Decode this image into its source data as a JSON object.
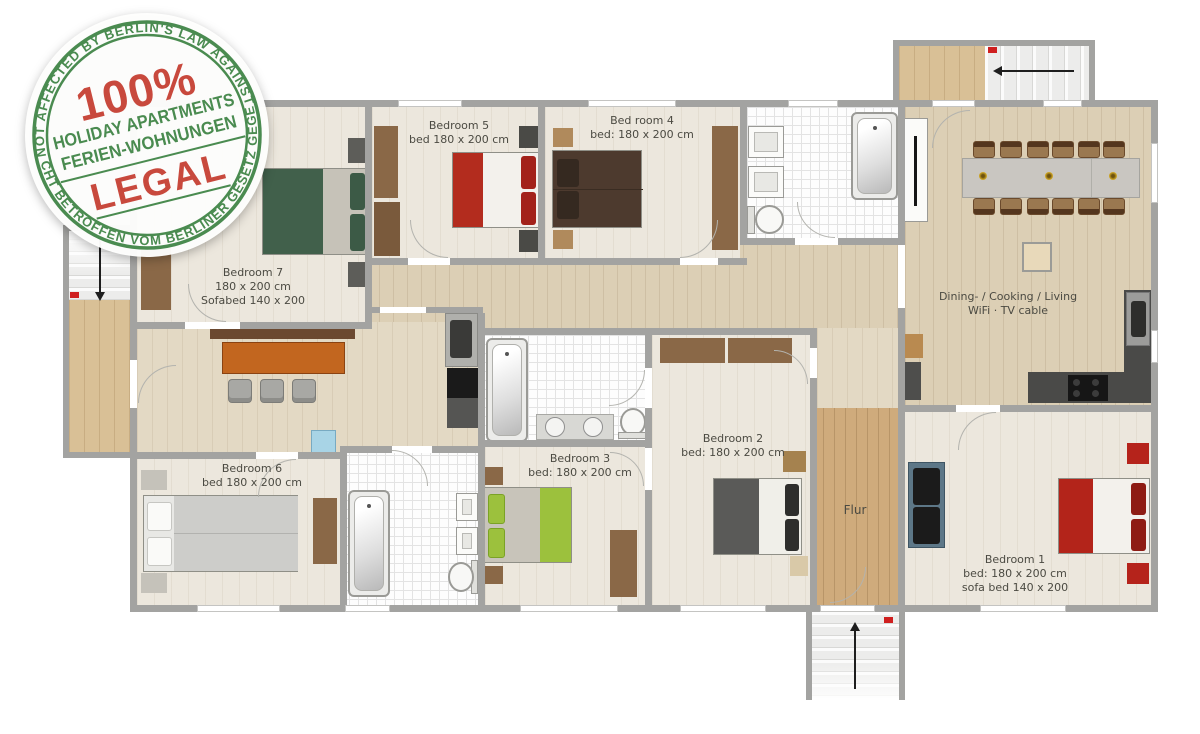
{
  "stamp": {
    "arc_top": "NOT AFFECTED BY BERLIN'S LAW AGAINST",
    "percent": "100%",
    "holiday": "HOLIDAY APARTMENTS",
    "ferien": "FERIEN-WOHNUNGEN",
    "legal": "LEGAL",
    "arc_bottom": "NICHT BETROFFEN VOM BERLINER GESETZ GEGEN",
    "green": "#4a8b50",
    "red": "#c8493d"
  },
  "rooms": {
    "bedroom7": {
      "line1": "Bedroom 7",
      "line2": "180 x 200 cm",
      "line3": "Sofabed 140 x 200"
    },
    "bedroom5": {
      "line1": "Bedroom 5",
      "line2": "bed 180 x 200 cm"
    },
    "bedroom4": {
      "line1": "Bed room 4",
      "line2": "bed: 180 x 200 cm"
    },
    "dining": {
      "line1": "Dining- / Cooking / Living",
      "line2": "WiFi · TV cable"
    },
    "bedroom6": {
      "line1": "Bedroom 6",
      "line2": "bed 180 x 200 cm"
    },
    "bedroom3": {
      "line1": "Bedroom 3",
      "line2": "bed: 180 x 200 cm"
    },
    "bedroom2": {
      "line1": "Bedroom 2",
      "line2": "bed: 180 x 200 cm"
    },
    "flur": {
      "line1": "Flur"
    },
    "bedroom1": {
      "line1": "Bedroom 1",
      "line2": "bed: 180 x 200 cm",
      "line3": "sofa bed 140 x 200"
    }
  },
  "colors": {
    "bed_red": "#b32c1e",
    "bed_dark_green": "#41604b",
    "bed_brown": "#4d3a2e",
    "bed_lime": "#9cc13d",
    "bed_gray": "#5a5a58",
    "sofa_blue": "#5d7787",
    "marker_red": "#cf1f1f",
    "wall_gray": "#a3a3a1"
  }
}
